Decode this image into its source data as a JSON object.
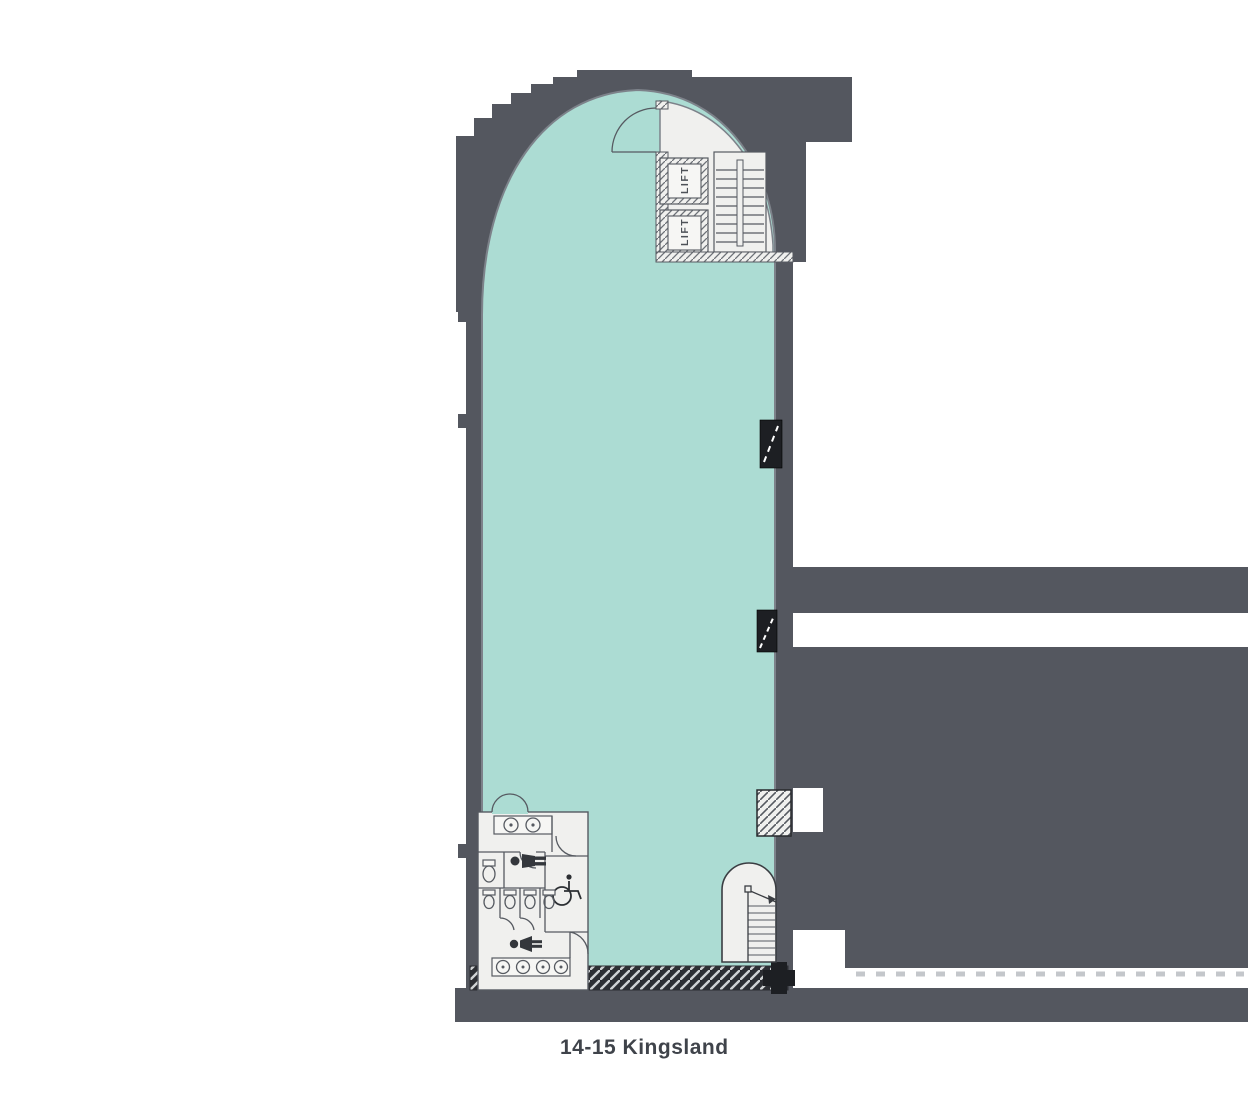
{
  "plan": {
    "title": "14-15 Kingsland",
    "lifts": [
      {
        "label": "LIFT"
      },
      {
        "label": "LIFT"
      }
    ],
    "icons": [
      "male-figure-icon",
      "female-figure-icon",
      "wheelchair-icon",
      "stair-icon"
    ],
    "colors": {
      "floor_fill": "#ACDCD3",
      "wall": "#54575F",
      "room_fill": "#F0F0EE",
      "hatch_strip": "#2C2E33",
      "riser_fill": "#1D1F23",
      "outline": "#565A61",
      "label_color": "#3F434A"
    }
  }
}
